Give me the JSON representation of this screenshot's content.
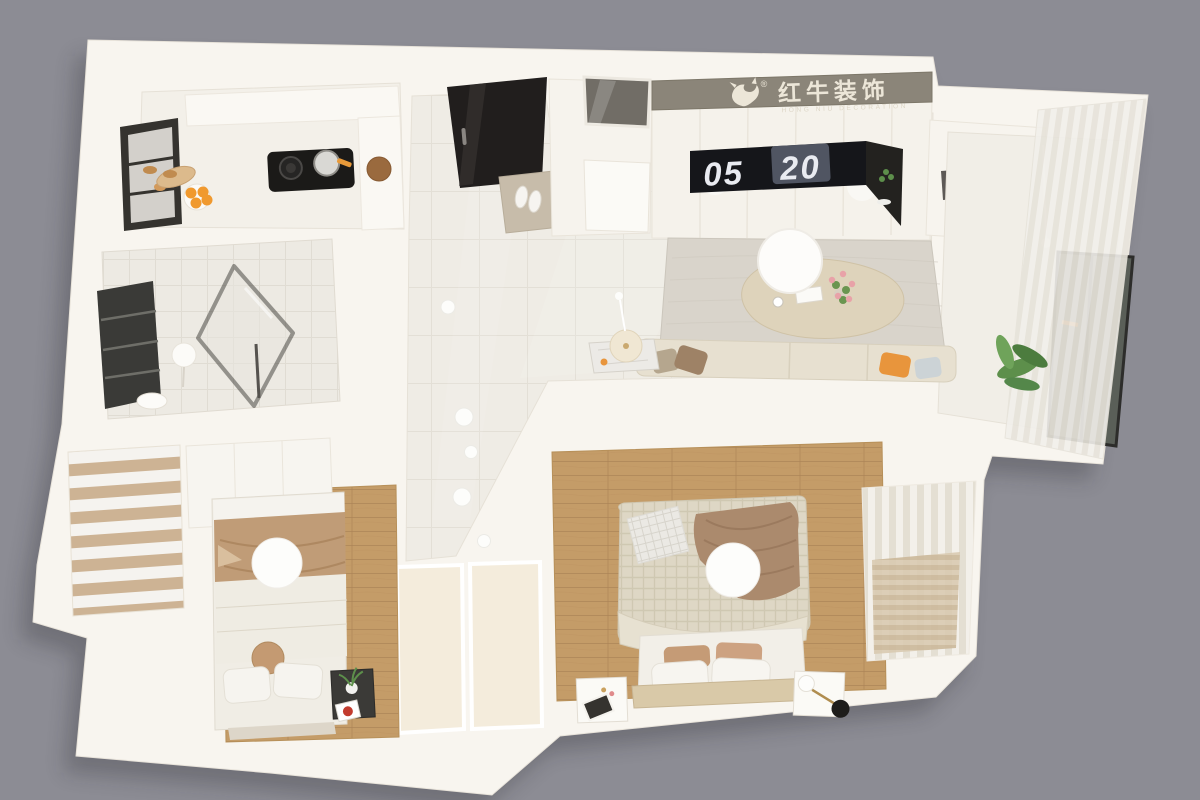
{
  "brand": {
    "registered": "®",
    "name_cn": "红牛装饰",
    "name_en": "HONG NIU DECORATION"
  },
  "clock": {
    "digits_left": "05",
    "digits_right": "20"
  },
  "colors": {
    "background": "#8c8c94",
    "wall": "#f8f5ef",
    "floor_tile": "#efece5",
    "wood": "#c49c68",
    "rug": "#d9d4cb",
    "sofa": "#e7e0d0",
    "coffee_table": "#ded3bb",
    "logo_band": "#8b8579",
    "logo_text": "#ece6d8",
    "clock_panel": "#15161a",
    "clock_text": "#e9ebf1",
    "door": "#211e1d",
    "doormat": "#c7bcaa",
    "accent_orange": "#e8953c",
    "plant_green": "#5d8f4b",
    "blanket_tan": "#c09c77",
    "throw_brown": "#ab8a6d"
  }
}
